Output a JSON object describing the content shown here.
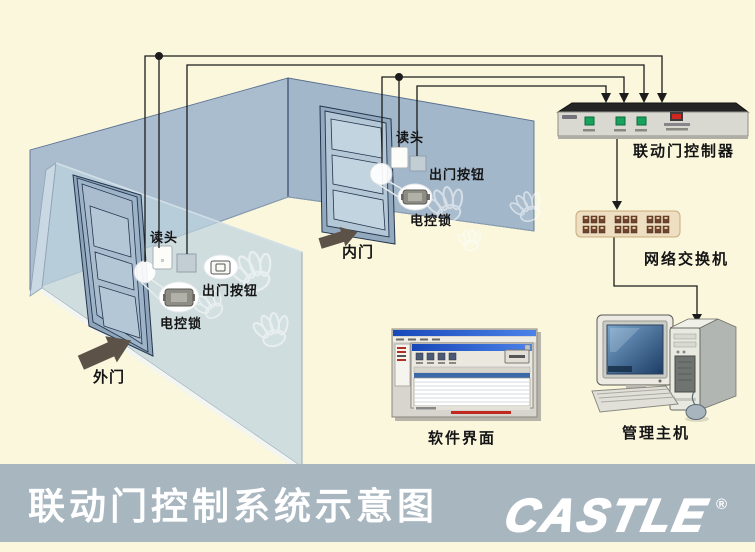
{
  "colors": {
    "background": "#faf7dd",
    "banner": "#a8b6c0",
    "wall": "#a9bdcf",
    "wall_right": "#a2b7ca",
    "glass_wall": "#c3d6e0",
    "wire": "#1c1c1c",
    "direction_arrow": "#5c5248",
    "controller_button_green": "#18a35c",
    "controller_led_red": "#d02820",
    "switch_body": "#eedec2",
    "switch_port": "#6e4630",
    "monitor_screen_blue": "#2a5a94",
    "title_text": "#ffffff"
  },
  "room": {
    "outer_door": {
      "arrow_label": "外门",
      "reader_label": "读头",
      "exit_button_label": "出门按钮",
      "lock_label": "电控锁"
    },
    "inner_door": {
      "arrow_label": "内门",
      "reader_label": "读头",
      "exit_button_label": "出门按钮",
      "lock_label": "电控锁"
    }
  },
  "equipment": {
    "controller_label": "联动门控制器",
    "switch_label": "网络交换机",
    "software_label": "软件界面",
    "host_label": "管理主机"
  },
  "footer": {
    "title": "联动门控制系统示意图",
    "logo_text": "CASTLE",
    "registered_mark": "®"
  }
}
